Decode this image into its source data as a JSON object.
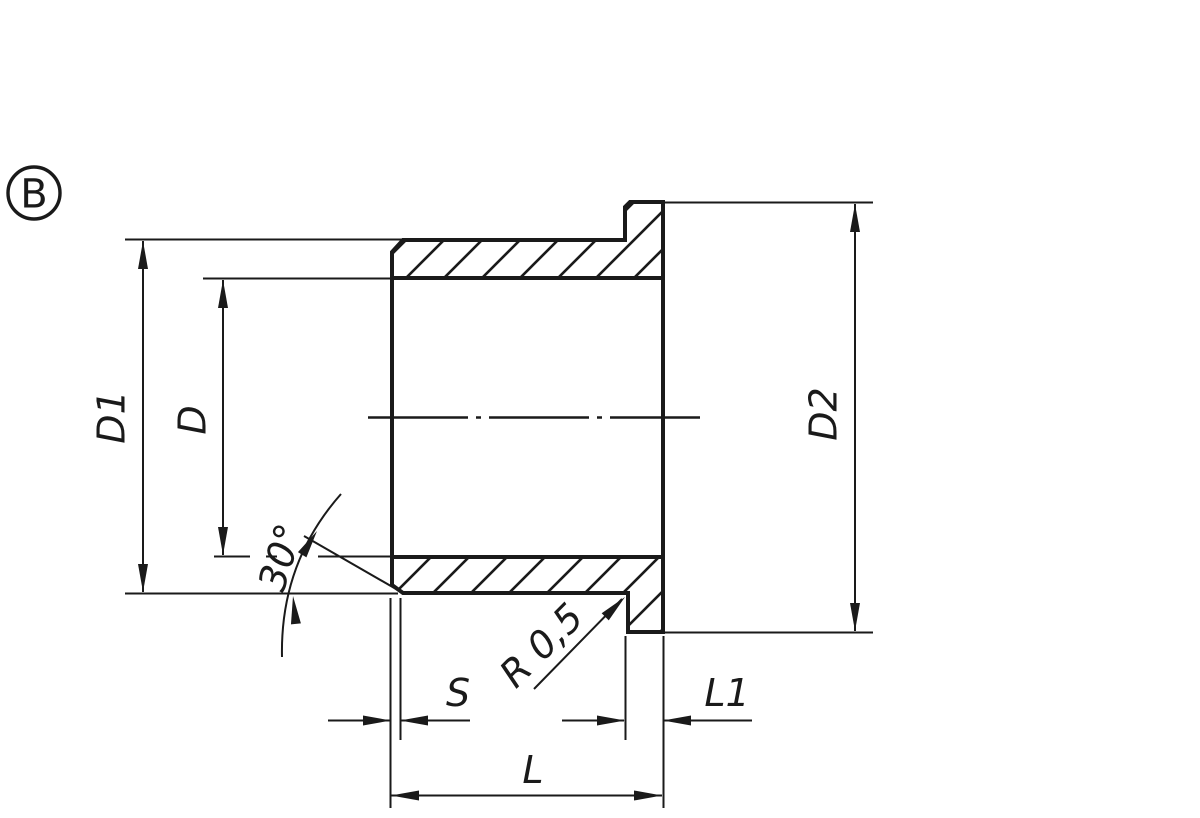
{
  "drawing": {
    "background": "#ffffff",
    "line_color": "#1a1a1a",
    "view_marker": {
      "label": "B"
    },
    "dimensions": {
      "d1": "D1",
      "d": "D",
      "d2": "D2",
      "angle": "30°",
      "radius": "R 0,5",
      "s": "S",
      "l1": "L1",
      "l": "L"
    }
  }
}
